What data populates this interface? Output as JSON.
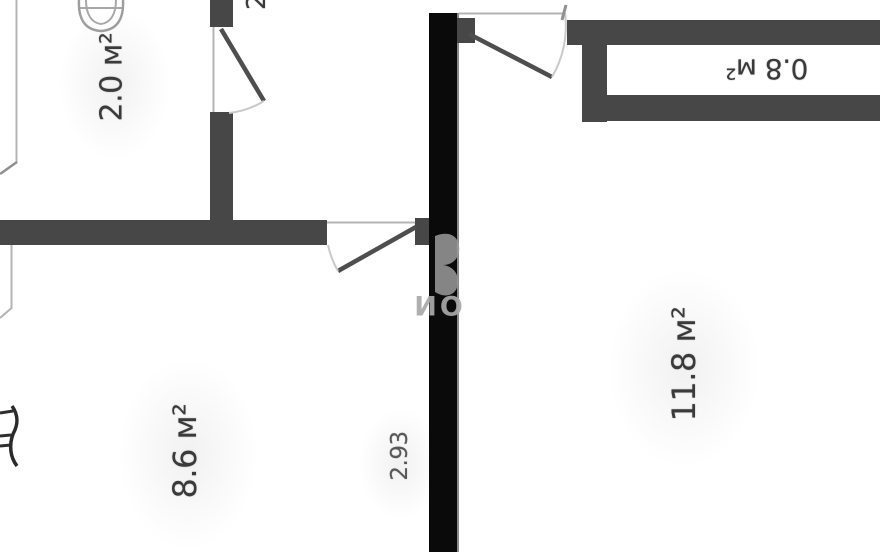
{
  "plan": {
    "rooms": [
      {
        "name": "wc",
        "area": "2.0 м²"
      },
      {
        "name": "hallway",
        "area": "8.6 м²"
      },
      {
        "name": "living-room",
        "area": "11.8 м²"
      },
      {
        "name": "balcony",
        "area": "0.8 м²"
      }
    ],
    "dimension_label": "2.93",
    "partial_top_label": "2",
    "watermark_text": "ИО"
  },
  "theme_colors": {
    "wall": "#474747",
    "black-bar": "#0a0a0a",
    "thin-line": "#b4b4b4",
    "door-leaf": "#4e4e4e",
    "arc": "#c9c9c9",
    "label-text": "#3a3a3a",
    "dim-text": "#585858",
    "watermark": "#a9a9a9",
    "bg": "#ffffff"
  }
}
